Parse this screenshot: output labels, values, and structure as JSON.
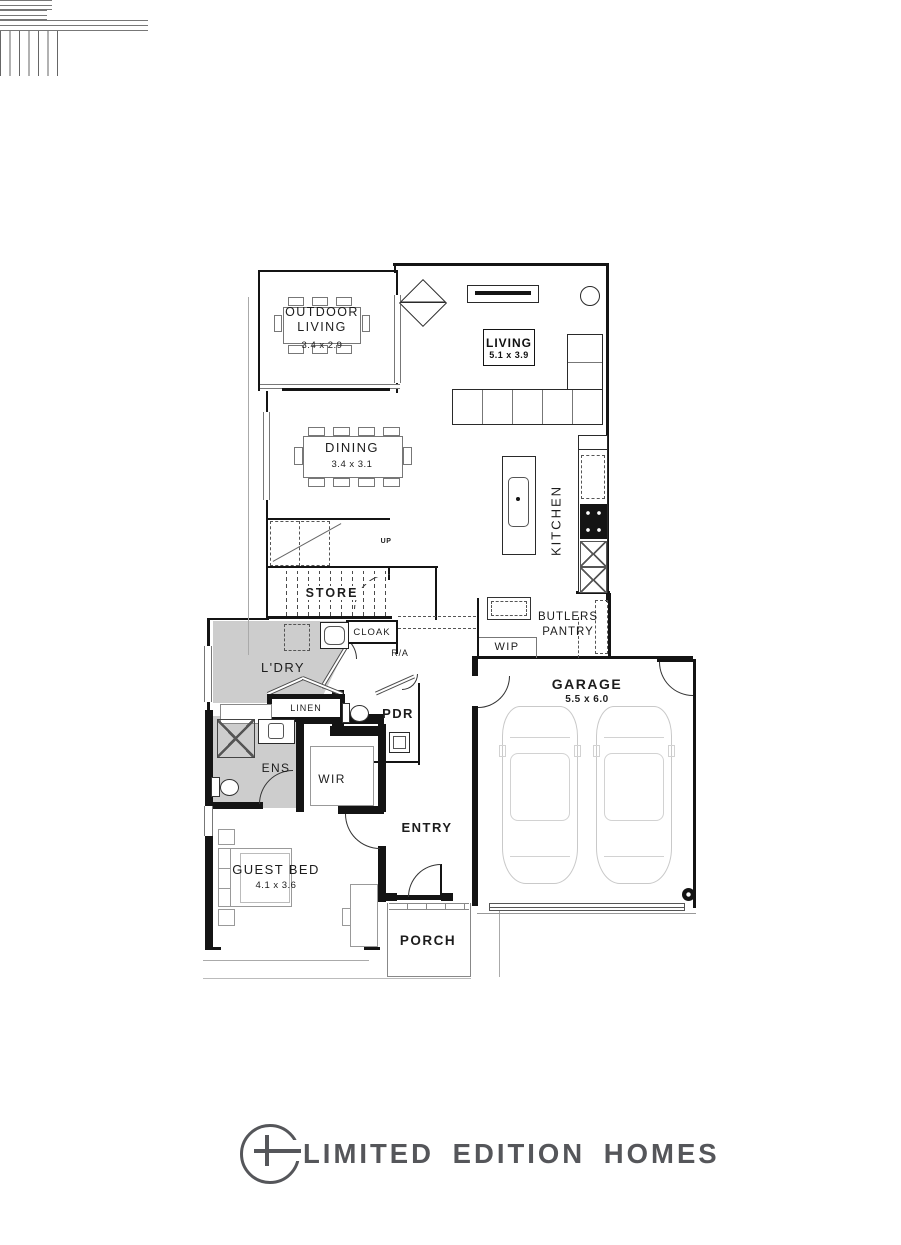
{
  "rooms": {
    "outdoor_living": {
      "line1": "OUTDOOR",
      "line2": "LIVING",
      "dims": "3.4 x 2.9"
    },
    "living": {
      "label": "LIVING",
      "dims": "5.1 x 3.9"
    },
    "dining": {
      "label": "DINING",
      "dims": "3.4 x 3.1"
    },
    "kitchen": {
      "label": "KITCHEN"
    },
    "stairs": {
      "label": "UP"
    },
    "store": {
      "label": "STORE"
    },
    "cloak": {
      "label": "CLOAK"
    },
    "return_air": {
      "label": "R/A"
    },
    "laundry": {
      "label": "L'DRY"
    },
    "linen": {
      "label": "LINEN"
    },
    "powder": {
      "label": "PDR"
    },
    "butlers_pantry": {
      "line1": "BUTLERS",
      "line2": "PANTRY"
    },
    "wip": {
      "label": "WIP"
    },
    "garage": {
      "label": "GARAGE",
      "dims": "5.5 x 6.0"
    },
    "ensuite": {
      "label": "ENS"
    },
    "wir": {
      "label": "WIR"
    },
    "entry": {
      "label": "ENTRY"
    },
    "guest_bed": {
      "label": "GUEST BED",
      "dims": "4.1 x 3.6"
    },
    "porch": {
      "label": "PORCH"
    }
  },
  "logo": {
    "text": "LIMITED EDITION HOMES"
  },
  "colors": {
    "wall": "#141414",
    "wet_area_shade": "#cdcdcd",
    "furniture_line": "#8a8a8a",
    "car_line": "#c9c9c9",
    "logo": "#55565a"
  }
}
